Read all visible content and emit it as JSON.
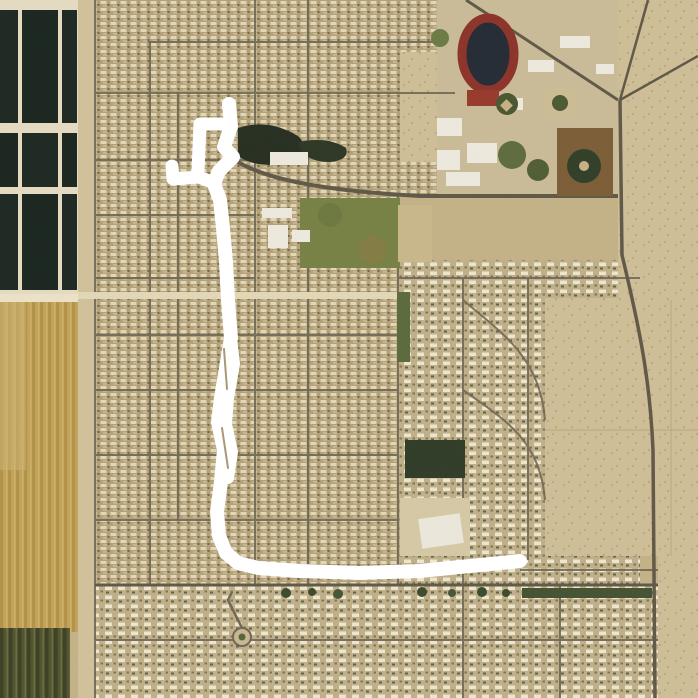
{
  "map": {
    "kind": "satellite-imagery-with-gps-route",
    "description": "Aerial view of a desert suburb: dark irrigation ponds and crop fields on the west edge, dense mobile-home residential blocks in the center, a school campus with red running track and baseball fields to the northeast, open desert parcels to the east, with a white GPS activity route overlaid.",
    "background_tone": "#c4b287"
  },
  "route": {
    "color": "#ffffff",
    "stroke_width": 14,
    "shape_summary": "Starts with a short stub and rectangular loop with a left spur at the north end, runs south with small zigzags and doubled overlapping strands, curves at the south end and runs east to a rounded endpoint.",
    "paths": {
      "spine": [
        [
          229,
          104
        ],
        [
          231,
          126
        ],
        [
          224,
          147
        ],
        [
          233,
          157
        ],
        [
          219,
          171
        ],
        [
          214,
          184
        ],
        [
          220,
          200
        ],
        [
          223,
          228
        ],
        [
          226,
          262
        ],
        [
          228,
          300
        ],
        [
          231,
          338
        ],
        [
          226,
          368
        ],
        [
          221,
          398
        ],
        [
          218,
          422
        ],
        [
          224,
          450
        ],
        [
          221,
          482
        ],
        [
          217,
          512
        ],
        [
          219,
          536
        ],
        [
          226,
          553
        ],
        [
          238,
          563
        ],
        [
          258,
          568
        ],
        [
          300,
          571
        ],
        [
          360,
          573
        ],
        [
          420,
          571
        ],
        [
          470,
          566
        ],
        [
          520,
          561
        ]
      ],
      "loop": [
        [
          231,
          124
        ],
        [
          200,
          124
        ],
        [
          198,
          171
        ]
      ],
      "spur": [
        [
          214,
          183
        ],
        [
          199,
          177
        ],
        [
          173,
          179
        ],
        [
          172,
          166
        ]
      ],
      "double_strand": [
        [
          231,
          338
        ],
        [
          234,
          364
        ],
        [
          228,
          398
        ],
        [
          226,
          424
        ],
        [
          232,
          452
        ],
        [
          228,
          478
        ]
      ],
      "sliver_gap_1": [
        [
          224,
          349
        ],
        [
          227,
          389
        ]
      ],
      "sliver_gap_2": [
        [
          222,
          428
        ],
        [
          228,
          468
        ]
      ]
    }
  },
  "features": {
    "ponds_color": "#1c2722",
    "gold_field_color": "#c2a357",
    "olive_field_color": "#50532f",
    "park_color": "#768144",
    "pond_trees_color": "#242e20",
    "stadium_track_color": "#8c3228",
    "stadium_infield_color": "#222a35",
    "street_color": "#6e6754",
    "desert_color": "#cfbf97",
    "labels": {
      "ponds": "irrigation-ponds",
      "gold_field": "crop-field",
      "olive_field": "dark-crop-field",
      "stadium": "running-track-stadium",
      "ballfields": "baseball-fields",
      "park": "school-park",
      "pond_park": "pond-with-trees",
      "church": "large-white-building",
      "roundabout": "roundabout",
      "desert": "desert-parcels"
    }
  }
}
